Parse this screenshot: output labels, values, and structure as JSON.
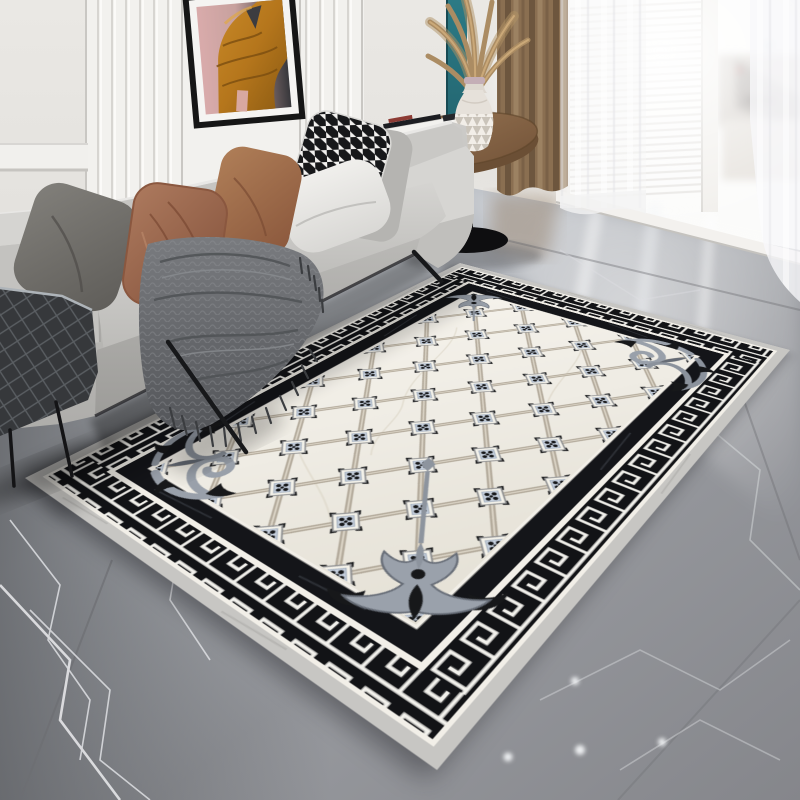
{
  "scene": {
    "kind": "living-room product photo, no visible text",
    "subject": "rectangular area rug with greek-key border on marble floor",
    "rug": {
      "field_color": "#f0ede5",
      "lattice_line_color": "#b2a99a",
      "rosette_frame_color": "#f4f2ea",
      "rosette_petal_color": "#c6d0de",
      "rosette_dot_color": "#17181a",
      "key_band_bg": "#121316",
      "key_color": "#f2f1ec",
      "inner_stripe_color": "#141519",
      "binding_color": "#c7c6c3",
      "ornaments": [
        "corner-crest-top",
        "corner-crest-bottom-with-stem",
        "damask-scroll-right-corner",
        "damask-scroll-left-corner"
      ],
      "lattice": {
        "columns": 4,
        "rows": 5
      }
    },
    "sofa": {
      "fabric_color": "#c4c3c0",
      "leg_color": "#1a1a1c"
    },
    "pillows": [
      {
        "name": "pillow-dark-taupe",
        "color": "#6f6c67"
      },
      {
        "name": "pillow-rust-left",
        "color": "#96604a"
      },
      {
        "name": "pillow-rust-right",
        "color": "#9c6a4b"
      },
      {
        "name": "pillow-gray",
        "color": "#b5b4b1"
      },
      {
        "name": "pillow-houndstooth",
        "colors": [
          "#f2f1ef",
          "#17181a"
        ]
      },
      {
        "name": "pillow-white",
        "color": "#eceae7"
      }
    ],
    "throw_blanket": {
      "color": "#67696d",
      "fringe_color": "#3b3d40"
    },
    "quilted_bench": {
      "color": "#36383b"
    },
    "side_table": {
      "top_color": "#8f6e4e",
      "base_color": "#0e0e10"
    },
    "vase": {
      "body_color": "#e6e1da",
      "pattern": "white triangles",
      "rim_color": "#c4aeb6"
    },
    "pampas_grass": {
      "color": "#ab8c63"
    },
    "artwork": {
      "frame_color": "#161616",
      "mat_color": "#f5f4f2",
      "subject": "figure in mustard robe",
      "bg_left": "#d9abab",
      "bg_right": "#37373b"
    },
    "wall": {
      "paint_color": "#e9e7e3",
      "paneling_color": "#f2f1ee",
      "accent_strip_color": "#2c7a85"
    },
    "curtain": {
      "color": "#8a6f51",
      "sheer_color": "#f7f7f8"
    },
    "window": {
      "glass_color": "#fbfbfa",
      "blinds_line_color": "#e2e0dd"
    },
    "floor": {
      "marble_base": "#9b9da2",
      "dark_side": "#707176",
      "bright_side": "#c3c7cd",
      "vein_color": "#e8eaec",
      "downlight_dot_color": "#eef0f2"
    }
  }
}
